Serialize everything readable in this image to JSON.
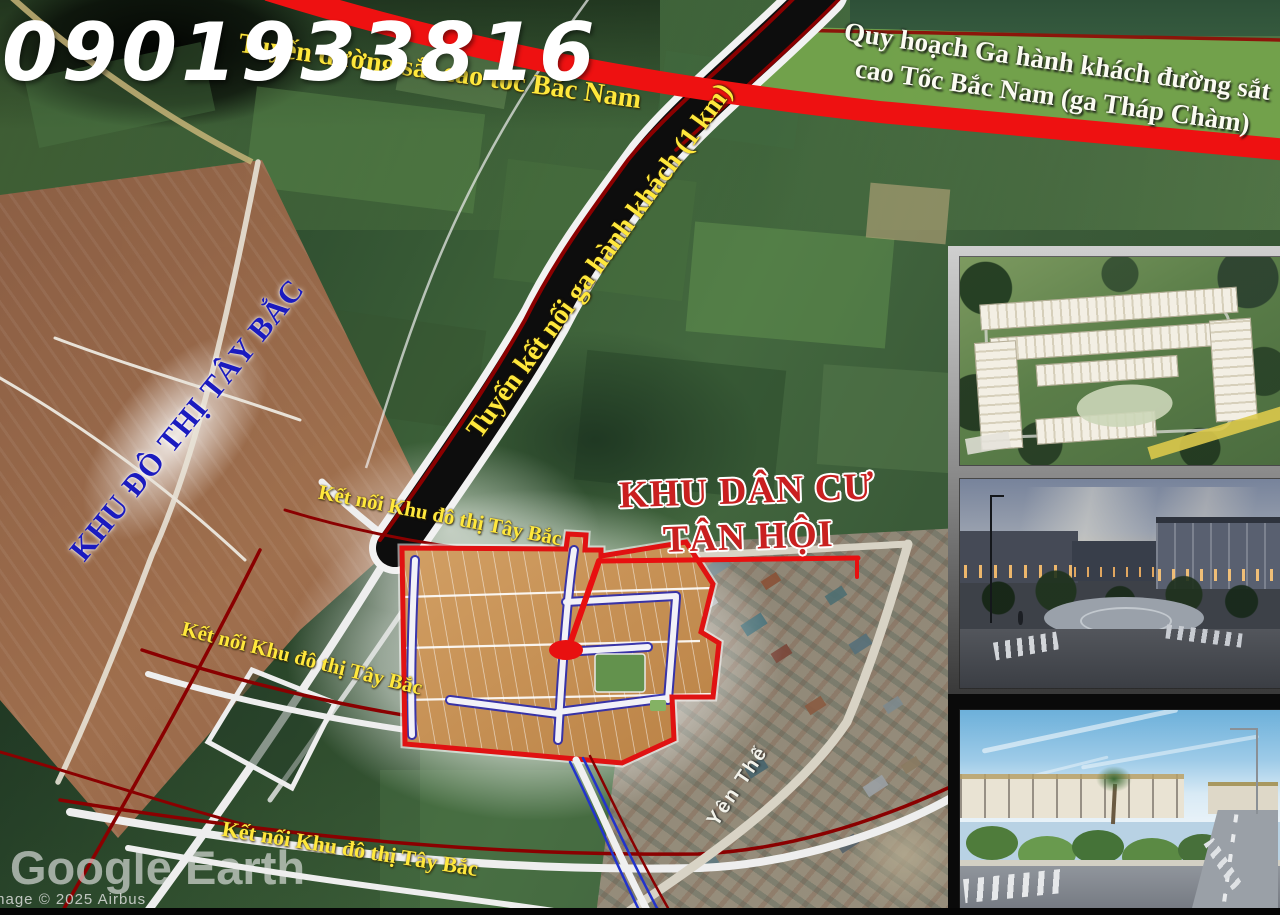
{
  "labels": {
    "phone": "0901933816",
    "railway": "Tuyến đường sắt cao tốc Bắc Nam",
    "station_line1": "Quy hoạch Ga hành khách đường sắt",
    "station_line2": "cao Tốc Bắc Nam (ga Tháp Chàm)",
    "connector_road": "Tuyến kết nối ga hành khách (1 km)",
    "urban_area": "KHU ĐÔ THỊ TÂY BẮC",
    "project_line1": "KHU DÂN CƯ",
    "project_line2": "TÂN HỘI",
    "connect_1": "Kết nối Khu đô thị Tây Bắc",
    "connect_2": "Kết nối Khu đô thị Tây Bắc",
    "connect_3": "Kết nối Khu đô thị Tây Bắc",
    "street": "Yên Thế"
  },
  "watermark": {
    "logo": "Google Earth",
    "attribution": "mage © 2025 Airbus"
  },
  "colors": {
    "railway_red": "#ee1111",
    "label_yellow": "#ffe83c",
    "project_red": "#c92020",
    "urban_blue": "#1b1bbf",
    "site_boundary_red": "#e01212",
    "site_fill_orange": "#c58d51",
    "station_green": "#74a34c",
    "planned_road_dark_red": "#8a0000",
    "internal_road_blue": "#2a2ab0"
  },
  "gallery": {
    "items": [
      {
        "name": "aerial-masterplan-render"
      },
      {
        "name": "evening-street-render"
      },
      {
        "name": "daytime-street-render"
      }
    ]
  }
}
